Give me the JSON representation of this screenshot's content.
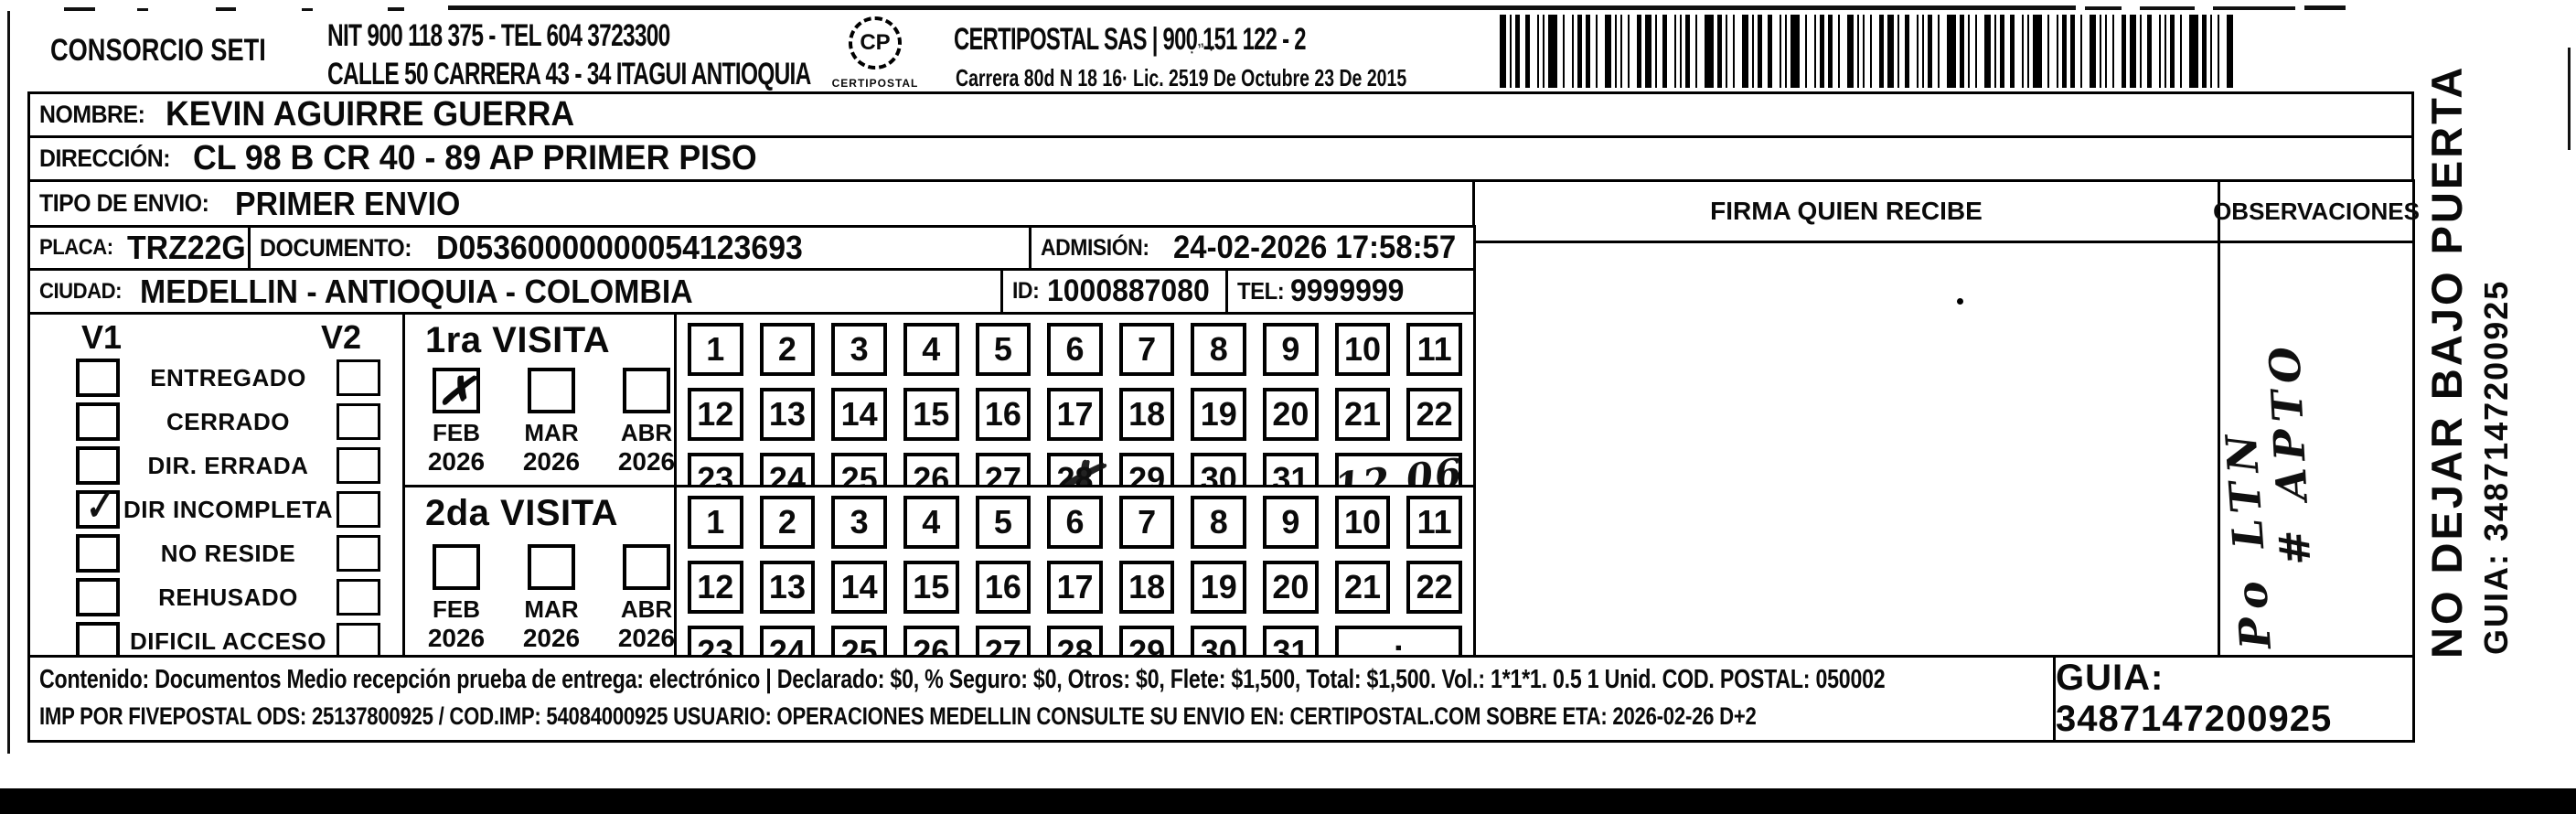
{
  "header": {
    "consorcio": "CONSORCIO SETI",
    "nit_line1": "NIT 900 118 375 - TEL 604 3723300",
    "address_line": "CALLE 50 CARRERA 43 - 34 ITAGUI ANTIOQUIA",
    "logo_monogram": "CP",
    "logo_label": "CERTIPOSTAL",
    "company_line1": "CERTIPOSTAL SAS | 900 151 122 - 2",
    "company_line2": "Carrera 80d N 18 16· Lic. 2519 De Octubre 23 De 2015"
  },
  "icons": {
    "logo": "certipostal-seal-icon",
    "barcode": "shipment-barcode"
  },
  "shipment": {
    "nombre_label": "NOMBRE:",
    "nombre_value": "KEVIN AGUIRRE GUERRA",
    "direccion_label": "DIRECCIÓN:",
    "direccion_value": "CL 98 B CR 40 - 89 AP PRIMER PISO",
    "tipo_label": "TIPO DE ENVIO:",
    "tipo_value": "PRIMER ENVIO",
    "placa_label": "PLACA:",
    "placa_value": "TRZ22G",
    "documento_label": "DOCUMENTO:",
    "documento_value": "D05360000000054123693",
    "admision_label": "ADMISIÓN:",
    "admision_value": "24-02-2026 17:58:57",
    "ciudad_label": "CIUDAD:",
    "ciudad_value": "MEDELLIN - ANTIOQUIA - COLOMBIA",
    "id_label": "ID:",
    "id_value": "1000887080",
    "tel_label": "TEL:",
    "tel_value": "9999999"
  },
  "status_panel": {
    "v1_header": "V1",
    "v2_header": "V2",
    "check_glyph": "✓",
    "options": [
      {
        "label": "ENTREGADO",
        "v1": false,
        "v2": false
      },
      {
        "label": "CERRADO",
        "v1": false,
        "v2": false
      },
      {
        "label": "DIR. ERRADA",
        "v1": false,
        "v2": false
      },
      {
        "label": "DIR INCOMPLETA",
        "v1": true,
        "v2": false
      },
      {
        "label": "NO RESIDE",
        "v1": false,
        "v2": false
      },
      {
        "label": "REHUSADO",
        "v1": false,
        "v2": false
      },
      {
        "label": "DIFICIL ACCESO",
        "v1": false,
        "v2": false
      }
    ]
  },
  "visits": {
    "month_check_glyph": "✗",
    "scribble_glyph": "✗",
    "first": {
      "title": "1ra VISITA",
      "months": [
        {
          "month": "FEB",
          "year": "2026",
          "checked": true
        },
        {
          "month": "MAR",
          "year": "2026",
          "checked": false
        },
        {
          "month": "ABR",
          "year": "2026",
          "checked": false
        }
      ],
      "days": [
        1,
        2,
        3,
        4,
        5,
        6,
        7,
        8,
        9,
        10,
        11,
        12,
        13,
        14,
        15,
        16,
        17,
        18,
        19,
        20,
        21,
        22,
        23,
        24,
        25,
        26,
        27,
        28,
        29,
        30,
        31
      ],
      "scribbled_day": 28,
      "time_note_handwritten": "12.06"
    },
    "second": {
      "title": "2da VISITA",
      "months": [
        {
          "month": "FEB",
          "year": "2026",
          "checked": false
        },
        {
          "month": "MAR",
          "year": "2026",
          "checked": false
        },
        {
          "month": "ABR",
          "year": "2026",
          "checked": false
        }
      ],
      "days": [
        1,
        2,
        3,
        4,
        5,
        6,
        7,
        8,
        9,
        10,
        11,
        12,
        13,
        14,
        15,
        16,
        17,
        18,
        19,
        20,
        21,
        22,
        23,
        24,
        25,
        26,
        27,
        28,
        29,
        30,
        31
      ],
      "time_placeholder": ":"
    }
  },
  "signature": {
    "header": "FIRMA QUIEN RECIBE"
  },
  "observations": {
    "header": "OBSERVACIONES",
    "handwritten_line1": "Po LTN",
    "handwritten_line2": "# APTO"
  },
  "side_note": {
    "line1": "NO DEJAR BAJO PUERTA",
    "line2": "GUIA: 3487147200925"
  },
  "footer": {
    "line1": "Contenido: Documentos Medio recepción prueba de entrega: electrónico | Declarado: $0, % Seguro: $0, Otros: $0, Flete: $1,500, Total: $1,500. Vol.: 1*1*1. 0.5  1 Unid. COD. POSTAL: 050002",
    "line2": "IMP POR FIVEPOSTAL ODS: 25137800925 / COD.IMP: 54084000925 USUARIO: OPERACIONES MEDELLIN CONSULTE SU ENVIO EN: CERTIPOSTAL.COM SOBRE ETA: 2026-02-26 D+2",
    "guia": "GUIA: 3487147200925"
  },
  "colors": {
    "ink": "#0a0a0a",
    "paper": "#ffffff"
  }
}
